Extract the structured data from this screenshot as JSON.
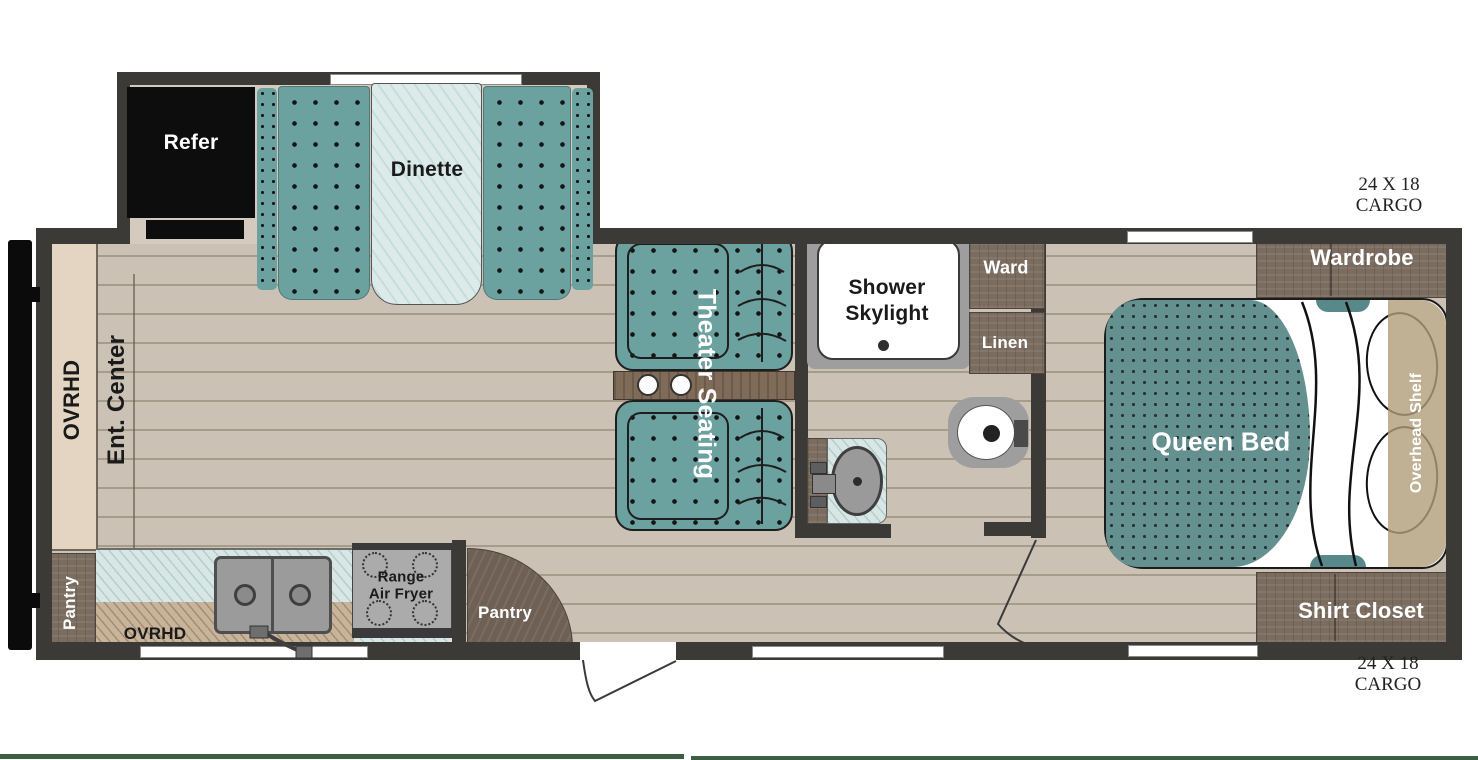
{
  "labels": {
    "refer": "Refer",
    "dinette": "Dinette",
    "ovhd_front": "OVRHD",
    "ent_center": "Ent. Center",
    "pantry_front": "Pantry",
    "ovhd_kitchen": "OVRHD",
    "range": {
      "line1": "Range",
      "line2": "Air Fryer"
    },
    "pantry_entry": "Pantry",
    "theater": "Theater Seating",
    "shower": {
      "line1": "Shower",
      "line2": "Skylight"
    },
    "ward": "Ward",
    "linen": "Linen",
    "queen_bed": "Queen Bed",
    "overhead_shelf": "Overhead Shelf",
    "wardrobe": "Wardrobe",
    "shirt_closet": "Shirt Closet",
    "cargo_top": {
      "line1": "24 X 18",
      "line2": "CARGO"
    },
    "cargo_bottom": {
      "line1": "24 X 18",
      "line2": "CARGO"
    }
  },
  "colors": {
    "wall": "#3c3a37",
    "floor_tan": "#cbc2b5",
    "seat_teal": "#6ba19f",
    "bed_teal": "#64908f",
    "counter_blue": "#d8e7e5",
    "overhead_tan": "#c7b49b",
    "cabinet_cream": "#e3d5c1",
    "cabinet_wood": "#7b6c60",
    "refrigerator_black": "#0d0d0d",
    "fixture_gray": "#9e9e9e",
    "divider_green": "#3c5e42"
  }
}
